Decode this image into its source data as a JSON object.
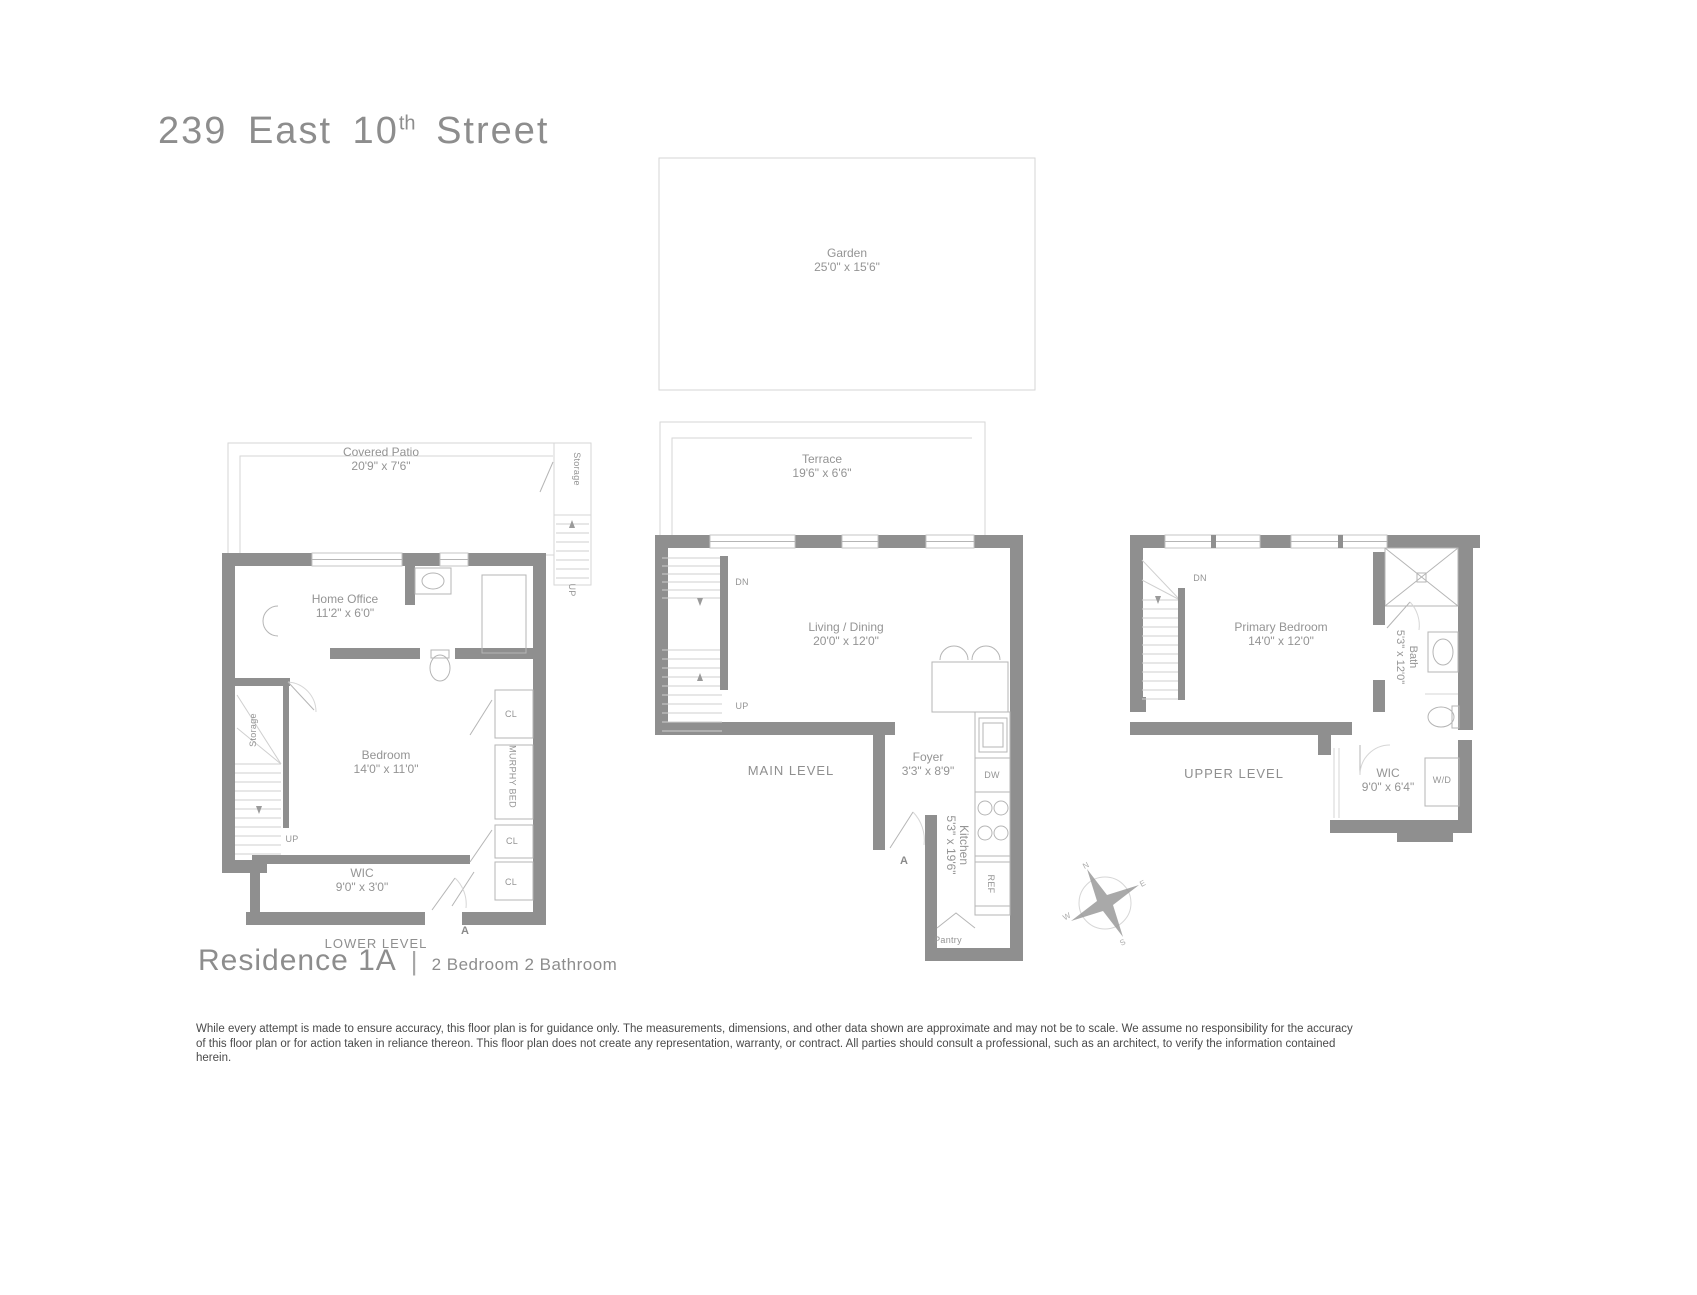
{
  "header": {
    "title_prefix": "239 East 10",
    "title_sup": "th",
    "title_suffix": " Street"
  },
  "lower": {
    "level_label": "LOWER LEVEL",
    "covered_patio_name": "Covered Patio",
    "covered_patio_dims": "20'9\" x 7'6\"",
    "storage_patio": "Storage",
    "patio_up": "UP",
    "home_office_name": "Home Office",
    "home_office_dims": "11'2\" x 6'0\"",
    "storage": "Storage",
    "bedroom_name": "Bedroom",
    "bedroom_dims": "14'0\" x 11'0\"",
    "murphy_bed": "MURPHY BED",
    "up": "UP",
    "cl": "CL",
    "wic_name": "WIC",
    "wic_dims": "9'0\" x 3'0\"",
    "entry_marker": "A"
  },
  "main": {
    "level_label": "MAIN LEVEL",
    "garden_name": "Garden",
    "garden_dims": "25'0\" x 15'6\"",
    "terrace_name": "Terrace",
    "terrace_dims": "19'6\" x 6'6\"",
    "living_name": "Living / Dining",
    "living_dims": "20'0\" x 12'0\"",
    "foyer_name": "Foyer",
    "foyer_dims": "3'3\" x 8'9\"",
    "kitchen_name": "Kitchen",
    "kitchen_dims": "5'3\" x 19'6\"",
    "pantry": "Pantry",
    "dw": "DW",
    "ref": "REF",
    "dn": "DN",
    "up": "UP",
    "entry_marker": "A"
  },
  "upper": {
    "level_label": "UPPER LEVEL",
    "primary_name": "Primary Bedroom",
    "primary_dims": "14'0\" x 12'0\"",
    "bath_name": "Bath",
    "bath_dims": "5'3\" x 12'0\"",
    "wic_name": "WIC",
    "wic_dims": "9'0\" x 6'4\"",
    "wd": "W/D",
    "dn": "DN"
  },
  "compass": {
    "n": "N",
    "e": "E",
    "s": "S",
    "w": "W"
  },
  "footer": {
    "residence": "Residence 1A",
    "separator": "|",
    "subtitle": "2 Bedroom 2 Bathroom",
    "disclaimer": "While every attempt is made to ensure accuracy, this floor plan is for guidance only. The measurements, dimensions, and other data shown are approximate and may not be to scale. We assume no responsibility for the accuracy of this floor plan or for action taken in reliance thereon. This floor plan does not create any representation, warranty, or contract. All parties should consult a professional, such as an architect, to verify the information contained herein."
  },
  "colors": {
    "wall": "#8f8f8f",
    "light_line": "#d6d6d6",
    "text": "#949494"
  }
}
